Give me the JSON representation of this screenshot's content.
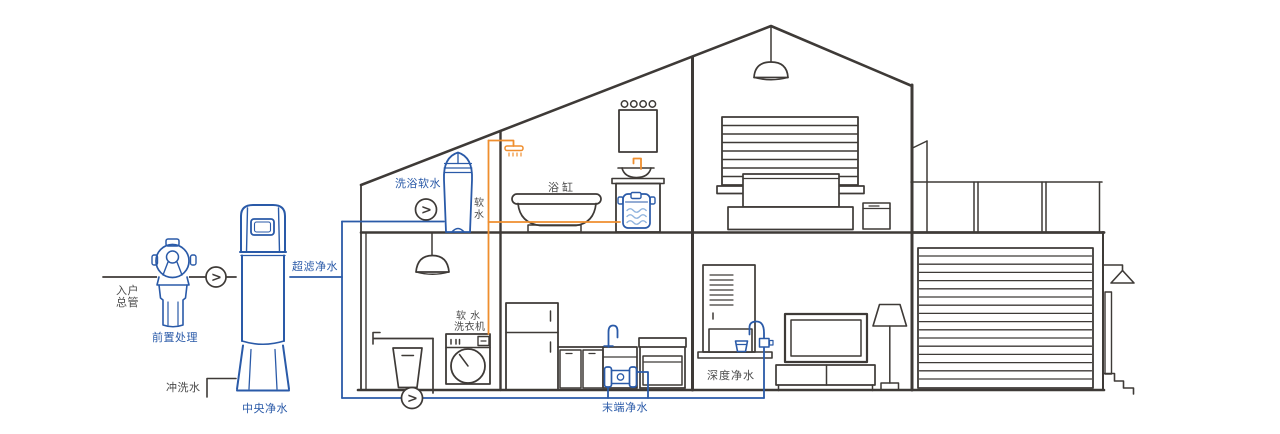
{
  "app": {
    "type": "whole-house-water-purification-diagram",
    "background": "#ffffff"
  },
  "colors": {
    "pipe_blue": "#2a5aa8",
    "pipe_orange": "#ef8e2e",
    "outline_dark": "#3e3a37",
    "label_dark": "#4a4a4a"
  },
  "icons": {
    "flow_arrow": ">"
  },
  "labels": {
    "entry_main_line1": "入户",
    "entry_main_line2": "总管",
    "pre_treatment": "前置处理",
    "central_purifier": "中央净水",
    "ultrafiltration": "超滤净水",
    "flush_water": "冲洗水",
    "bath_softener": "洗浴软水",
    "soft_water_char1": "软",
    "soft_water_char2": "水",
    "bathtub": "浴缸",
    "washer_line1": "软 水",
    "washer_line2": "洗衣机",
    "terminal_purifier": "末端净水",
    "deep_purifier": "深度净水"
  }
}
